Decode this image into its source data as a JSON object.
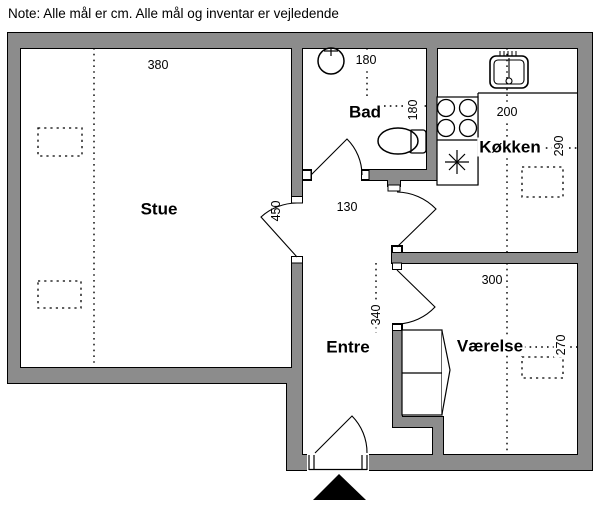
{
  "note": "Note: Alle mål er cm. Alle mål og inventar er vejledende",
  "rooms": {
    "stue": {
      "label": "Stue"
    },
    "bad": {
      "label": "Bad"
    },
    "kokken": {
      "label": "Køkken"
    },
    "entre": {
      "label": "Entre"
    },
    "vaerelse": {
      "label": "Værelse"
    }
  },
  "dims": {
    "stue_width": "380",
    "stue_height": "450",
    "hall_width": "130",
    "bad_width": "180",
    "bad_height": "180",
    "kokken_width": "200",
    "kokken_height": "290",
    "entre_height": "340",
    "vaerelse_width": "300",
    "vaerelse_height": "270"
  },
  "icons": {
    "bad_basin": "round-washbasin-icon",
    "toilet": "toilet-icon",
    "kitchen_sink": "kitchen-sink-icon",
    "stove": "stove-four-burners-icon",
    "appliance": "asterisk-appliance-icon",
    "wardrobe": "wardrobe-icon",
    "entrance": "entrance-triangle-icon"
  },
  "colors": {
    "wall_fill": "#8c8c8c",
    "wall_outline": "#000000",
    "floor": "#ffffff",
    "ink": "#000000"
  }
}
